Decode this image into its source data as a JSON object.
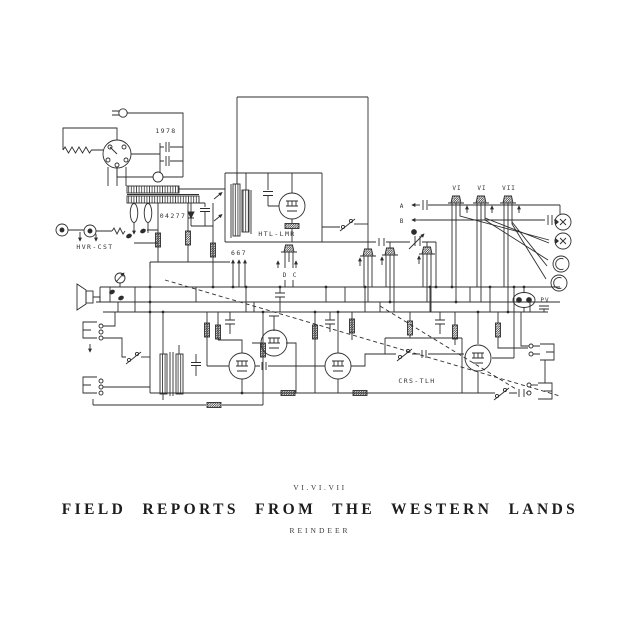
{
  "artwork": {
    "catalog": "VI.VI.VII",
    "title": "FIELD REPORTS FROM THE WESTERN LANDS",
    "artist": "REINDEER"
  },
  "schematic": {
    "labels": {
      "year": "1978",
      "part": "04277",
      "module_htl": "HTL-LMR",
      "module_hvr": "HVR-CST",
      "module_crs": "CRS-TLH",
      "value": "667",
      "pin_d": "D",
      "pin_c": "C",
      "tube1": "VI",
      "tube2": "VI",
      "tube3": "VII",
      "node_a": "A",
      "node_b": "B",
      "connector": "PV"
    },
    "colors": {
      "ink": "#2d2d2d",
      "background": "#ffffff"
    }
  }
}
